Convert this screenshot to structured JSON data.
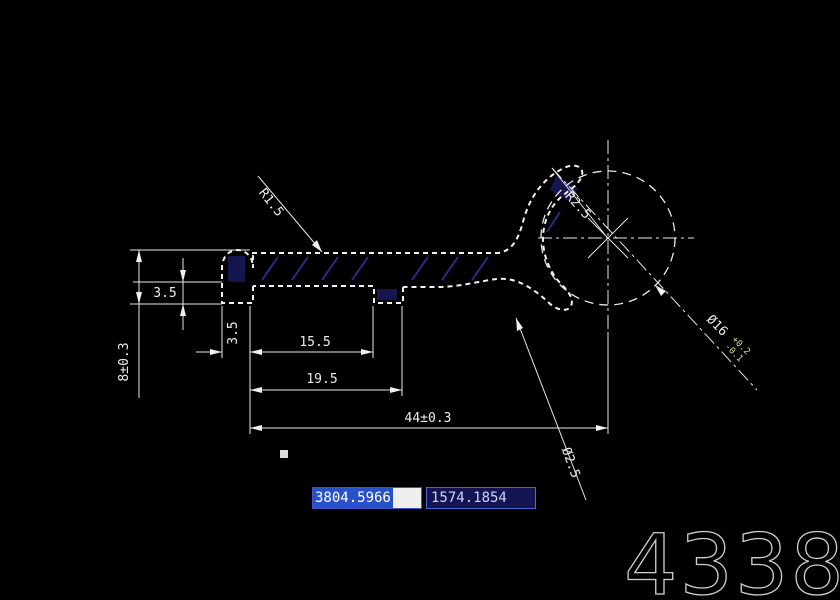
{
  "canvas": {
    "background": "#000000",
    "line_color": "#f2f2f2",
    "hatch_color": "#2a2a85",
    "section_fill": "#151550",
    "highlight_blue": "#2850c8",
    "box_navy": "#141452"
  },
  "drawing": {
    "dimensions": {
      "fillet_radius": "R1.5",
      "overall_height": "8±0.3",
      "step_height": "3.5",
      "tab_width": "3.5",
      "inner_length": "15.5",
      "notch_length": "19.5",
      "overall_length": "44±0.3",
      "head_radius": "R2.5",
      "section_label": "Ø2.5",
      "bore_diameter": "Ø16",
      "bore_tol_upper": "+0.2",
      "bore_tol_lower": "-0.1"
    },
    "watermark": "4338"
  },
  "statusbar": {
    "coord_x": "3804.5966",
    "coord_y": "1574.1854"
  }
}
